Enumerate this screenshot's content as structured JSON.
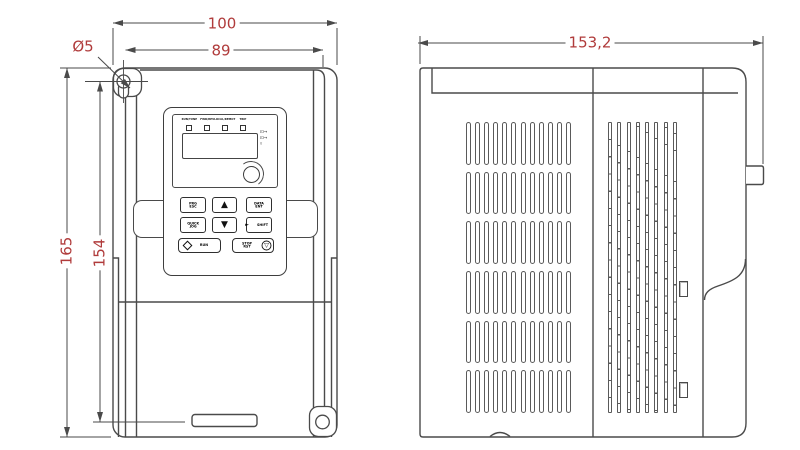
{
  "colors": {
    "background": "#ffffff",
    "line": "#4a4a4a",
    "dimension_text": "#b03b3b"
  },
  "front_view": {
    "dimensions": {
      "outer_width": "100",
      "inner_width": "89",
      "hole_diameter": "Ø5",
      "outer_height": "165",
      "inner_height": "154"
    },
    "keypad": {
      "led_labels": [
        "RUN/TUNE",
        "FWD/REV",
        "LOCAL/REMOT",
        "TRIP"
      ],
      "display_value": "",
      "buttons": {
        "prg_esc": "PRG ESC",
        "up": "▲",
        "data_ent": "DATA ENT",
        "quick_jog": "QUICK JOG",
        "down": "▼",
        "shift": "SHIFT",
        "run": "RUN",
        "stop_rst": "STOP RST"
      }
    }
  },
  "side_view": {
    "dimensions": {
      "depth": "153,2"
    },
    "vent_grid": {
      "rows": 6,
      "columns": 12
    },
    "fin_columns": 8,
    "clip_count": 2
  },
  "icons": {
    "up_arrow": "▲",
    "down_arrow": "▼",
    "run_diamond": "run-diamond-icon",
    "stop_symbol": "▽",
    "shift_arrow": "►",
    "unit_indicators": "⊡→\n⊡→\n▿"
  }
}
